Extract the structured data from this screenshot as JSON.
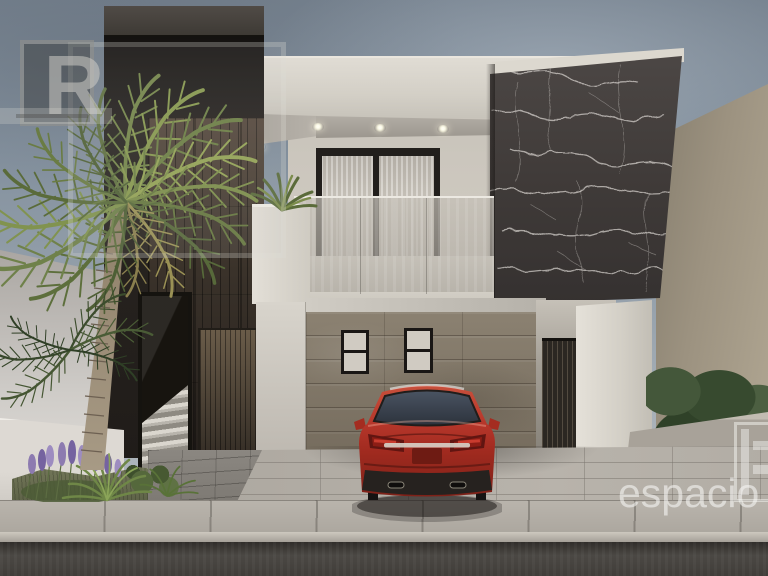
{
  "watermarks": {
    "corner_logo_letter": "R",
    "brand_text": "espacio"
  },
  "palette": {
    "sky": "#8b97a4",
    "facade_white": "#d6d2c9",
    "dark_wood_volume": "#3a322a",
    "marble_wall": "#423d3b",
    "marble_veins": "#e8e4df",
    "carport_wood_wall": "#8b8171",
    "glass_railing": "#b4aea6",
    "car_red": "#b23225",
    "pavement": "#b2ada5",
    "street_asphalt": "#403d39",
    "palm_green": "#6d7d42",
    "lavender_purple": "#8d7bb0",
    "hedge_green": "#374a2f",
    "neighbor_wall_beige": "#a2987f",
    "downlight_glow": "#fffef2",
    "watermark_white": "#fcfcfa"
  }
}
